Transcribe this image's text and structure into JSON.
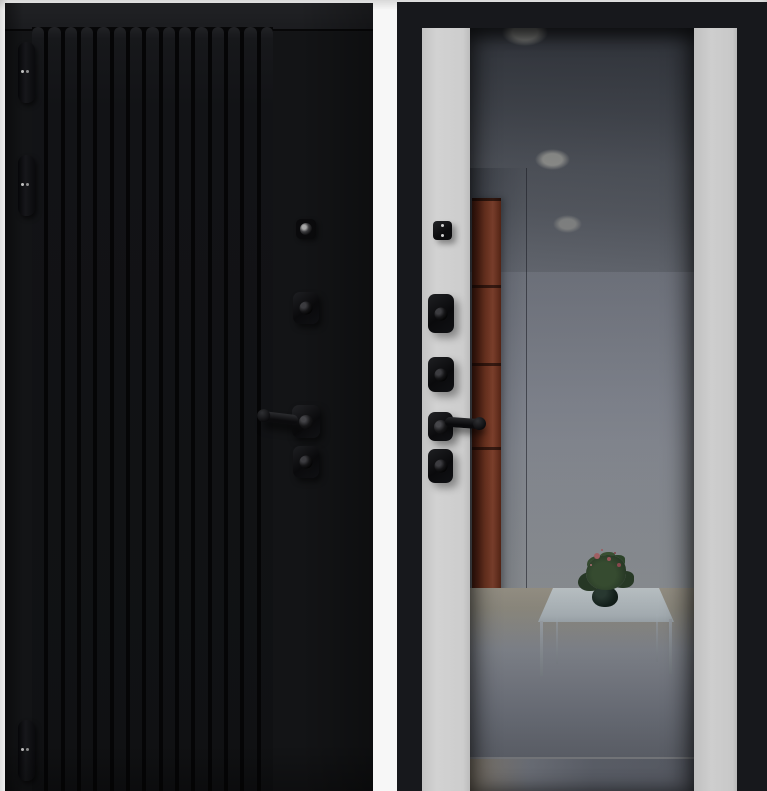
{
  "product": {
    "description": "steel entrance door shown as two panels: exterior front side and interior back side",
    "panel_front": {
      "finish": "black matte with vertical slat cladding",
      "slat_count": 15,
      "hinges": 3,
      "hardware_top_to_bottom": [
        "peephole",
        "upper-lock-escutcheon",
        "lever-handle",
        "lower-lock-escutcheon"
      ]
    },
    "panel_back": {
      "finish": "black frame with light side strips and full-height tinted mirror",
      "hardware_top_to_bottom": [
        "fixing-plate",
        "upper-deadbolt-escutcheon",
        "middle-deadbolt-escutcheon",
        "lever-handle",
        "lower-deadbolt-escutcheon"
      ],
      "mirror_reflection": {
        "ceiling_lights": 3,
        "objects": [
          "hallway ceiling",
          "brown tall cabinet",
          "glass coffee table",
          "potted flowering plant",
          "tiled floor"
        ]
      }
    }
  },
  "colors": {
    "background": "#f7f7f7",
    "door_black": "#131416",
    "frame_black": "#17181c",
    "strip_light": "#cdcdcd",
    "mirror_ceiling": "#4b4f57",
    "mirror_wall": "#868a94",
    "mirror_floor_beige": "#a59f91",
    "mirror_floor_gray": "#666a74",
    "cabinet_brown": "#7c3a24",
    "table_glass": "#d2dbdf",
    "plant_green": "#32462e",
    "flower_pink": "#b46a6e"
  }
}
